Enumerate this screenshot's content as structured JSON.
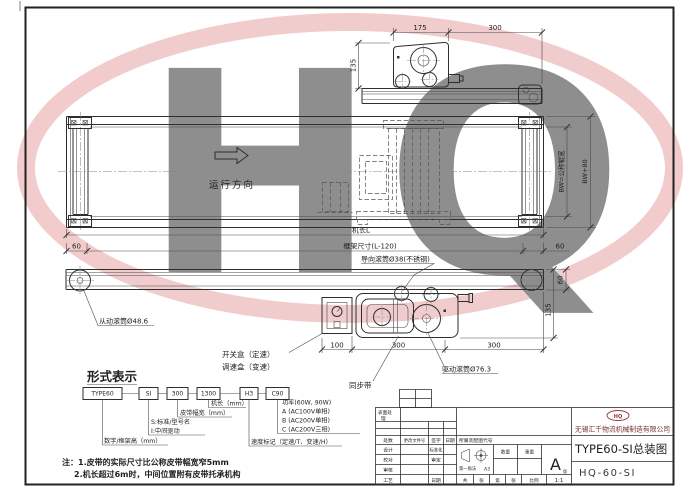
{
  "watermark": {
    "text": "HQ"
  },
  "views": {
    "direction": "运行方向",
    "dim_175": "175",
    "dim_300": "300",
    "dim_135": "135",
    "dim_60": "60",
    "dim_100": "100",
    "dim_bw_inner": "BW=公称辊宽",
    "dim_bw_outer": "BW+80",
    "dim_machine_length": "机长L",
    "dim_frame": "框架尺寸(L-120)",
    "label_guide_roller": "导向滚筒Ø38(不锈钢)",
    "label_driven_roller": "从动滚筒Ø48.6",
    "label_switch_box": "开关盒（定速）",
    "label_speed_box": "调速盒（变速）",
    "label_sync_belt": "同步带",
    "label_drive_roller": "驱动滚筒Ø76.3"
  },
  "legend": {
    "title": "形式表示",
    "boxes": [
      "TYPE60",
      "SI",
      "300",
      "1300",
      "H3",
      "C90"
    ],
    "label_machine_length": "机长（mm）",
    "label_belt_width": "皮带幅宽（mm）",
    "label_s": "S:标准/型号名",
    "label_i": "I:中间驱动",
    "label_frame_height": "数字/框架高（mm）",
    "power_title": "功率(60W, 90W)",
    "power_a": "A (AC100V单相)",
    "power_b": "B (AC200V单相)",
    "power_c": "C (AC200V三相)",
    "label_speed_mark": "速度标记（定速/T、变速/H）"
  },
  "notes": {
    "line1": "注：1.皮带的实际尺寸比公称皮带幅宽窄5mm",
    "line2": "2.机长超过6m时，中间位置附有皮带托承机构"
  },
  "title_block": {
    "surface": [
      "表面处",
      "理"
    ],
    "rev_count": "处数",
    "rev_doc": "更改文件号",
    "rev_sign": "签字",
    "rev_date": "日期",
    "design": "设计",
    "standardize": "标准化",
    "proofread": "校对",
    "approve": "审定",
    "review": "审核",
    "process": "工艺",
    "date": "日期",
    "assembly_code": "所属装配图代号",
    "projection": "第一角法",
    "sheet_size": "A3",
    "qty": "数量",
    "weight": "重量",
    "version": "A",
    "version_suffix": "版",
    "sheets_total": "共",
    "sheets_unit1": "张",
    "sheets_no": "第",
    "sheets_unit2": "张",
    "scale_label": "比例",
    "scale_value": "1:1",
    "logo": "HQ",
    "company": "无锡汇千物流机械制造有限公司",
    "title": "TYPE60-SI总装图",
    "code": "HQ-60-SI"
  }
}
